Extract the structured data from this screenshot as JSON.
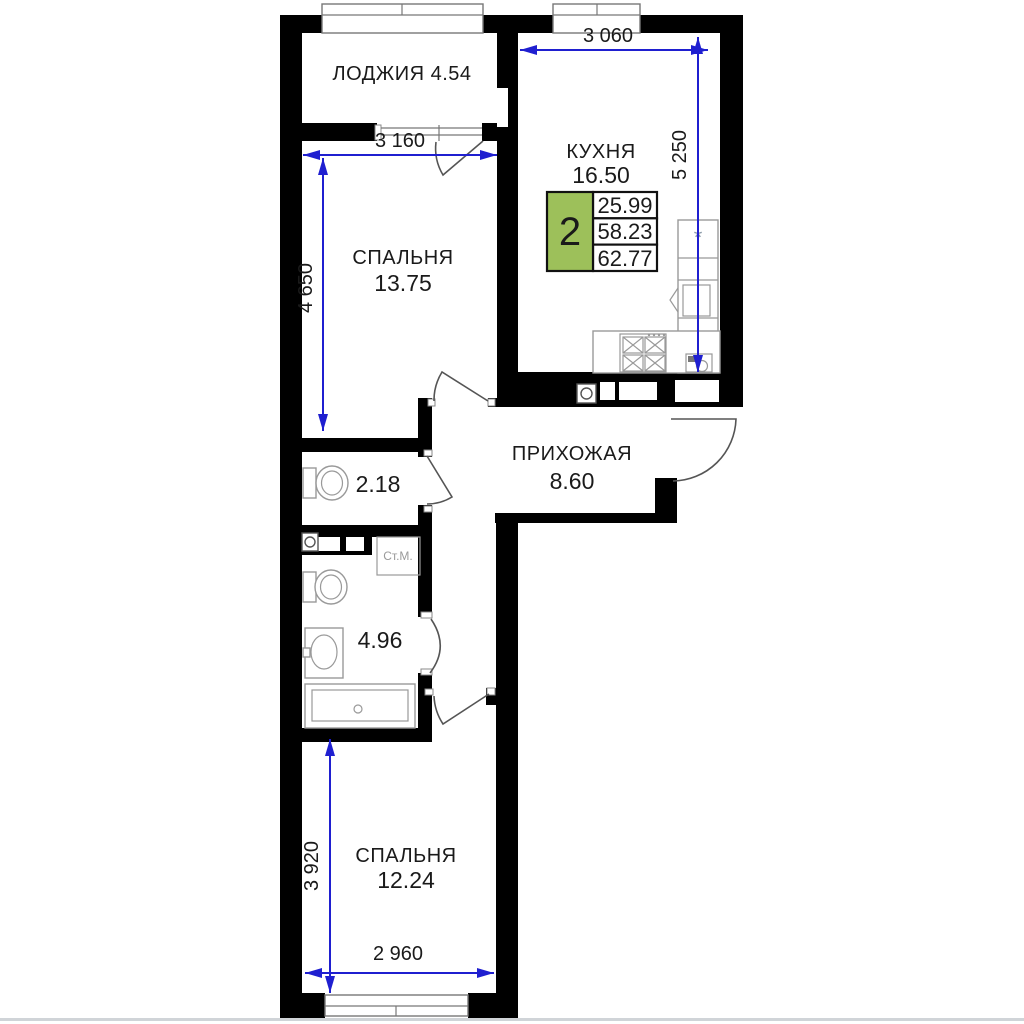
{
  "floorplan": {
    "info_box": {
      "rooms_count": "2",
      "values": [
        "25.99",
        "58.23",
        "62.77"
      ]
    },
    "rooms": {
      "loggia": {
        "label": "ЛОДЖИЯ 4.54"
      },
      "kitchen": {
        "name": "КУХНЯ",
        "area": "16.50"
      },
      "bedroom1": {
        "name": "СПАЛЬНЯ",
        "area": "13.75"
      },
      "hallway": {
        "name": "ПРИХОЖАЯ",
        "area": "8.60"
      },
      "wc": {
        "area": "2.18"
      },
      "bathroom": {
        "area": "4.96"
      },
      "bedroom2": {
        "name": "СПАЛЬНЯ",
        "area": "12.24"
      }
    },
    "fixtures": {
      "washing_machine_label": "Ст.М.",
      "fridge_mark": "*"
    },
    "dimensions": {
      "kitchen_width": "3 060",
      "kitchen_height": "5 250",
      "bedroom1_width": "3 160",
      "bedroom1_height": "4 650",
      "bedroom2_height": "3 920",
      "bedroom2_width": "2 960"
    },
    "colors": {
      "dimension_blue": "#1f1fd0",
      "info_green": "#9dc05a",
      "wall_black": "#000000"
    }
  }
}
